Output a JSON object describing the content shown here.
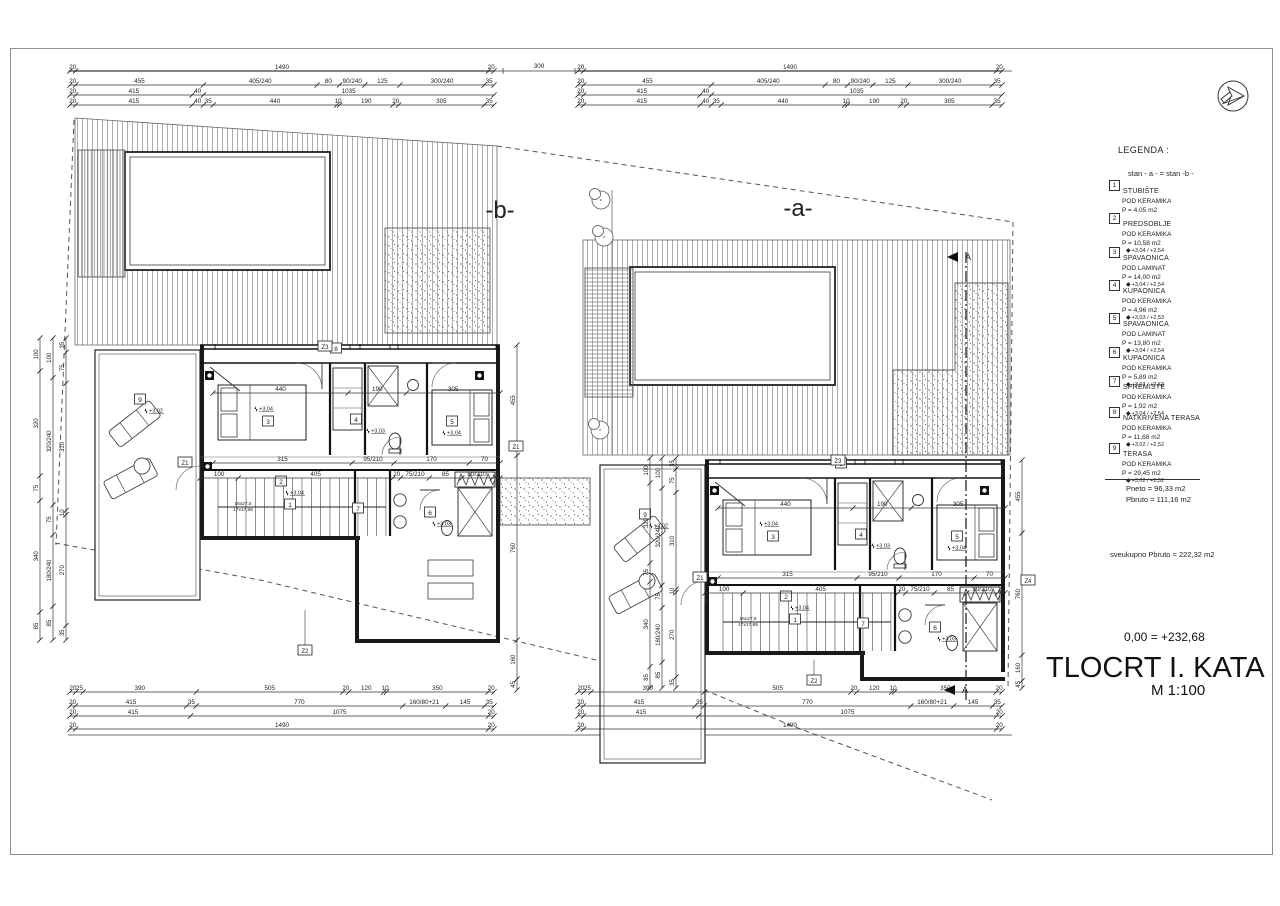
{
  "sheet": {
    "title": "TLOCRT I. KATA",
    "scale": "M 1:100",
    "datum": "0,00 = +232,68"
  },
  "units": {
    "b": "-b-",
    "a": "-a-"
  },
  "section": {
    "label": "A"
  },
  "markers": {
    "z1": "Z1",
    "z2": "Z2",
    "z3": "Z3",
    "z4": "Z4"
  },
  "stairs": {
    "line1": "16x27,5",
    "line2": "17x17,88"
  },
  "rooms": {
    "r1": {
      "num": "1"
    },
    "r2": {
      "num": "2",
      "level": "+3,04"
    },
    "r3": {
      "num": "3",
      "level": "+3,04"
    },
    "r4": {
      "num": "4",
      "level": "+3,03"
    },
    "r5": {
      "num": "5",
      "level": "+3,04"
    },
    "r6": {
      "num": "6",
      "level": "+3,03"
    },
    "r7": {
      "num": "7"
    },
    "r8": {
      "num": "8"
    },
    "r9": {
      "num": "9",
      "level": "+3,02"
    }
  },
  "dims": {
    "gap": "300",
    "top": [
      [
        "20",
        "1490",
        "20"
      ],
      [
        "20",
        "455",
        "405/240",
        "80",
        "90/240",
        "125",
        "300/240",
        "35"
      ],
      [
        "20",
        "415",
        "40",
        "1035"
      ],
      [
        "20",
        "415",
        "40",
        "35",
        "440",
        "10",
        "190",
        "20",
        "305",
        "35"
      ]
    ],
    "bottom": [
      [
        "20",
        "25",
        "390",
        "505",
        "20",
        "120",
        "10",
        "350",
        "20"
      ],
      [
        "20",
        "415",
        "35",
        "770",
        "160/80+21",
        "145",
        "35"
      ],
      [
        "20",
        "415",
        "1075",
        "20"
      ],
      [
        "20",
        "1490",
        "20"
      ]
    ],
    "left": [
      [
        "100",
        "320",
        "75",
        "340",
        "85"
      ],
      [
        "100",
        "320/240",
        "75",
        "180/240",
        "85"
      ],
      [
        "35",
        "75",
        "310",
        "10",
        "270",
        "35"
      ]
    ],
    "right": [
      "455",
      "760",
      "160",
      "45"
    ],
    "interior": {
      "r1": [
        "315",
        "95/210",
        "170",
        "70"
      ],
      "r2": [
        "100",
        "405",
        "20",
        "75/210",
        "85",
        "80/210",
        "20"
      ],
      "r3": [
        "440",
        "190",
        "305"
      ]
    }
  },
  "legend": {
    "heading": "LEGENDA :",
    "note": "stan - a - = stan -b -",
    "items": [
      {
        "num": "1",
        "name": "STUBIŠTE",
        "floor": "POD KERAMIKA",
        "area": "P = 4,05 m2",
        "levels": ""
      },
      {
        "num": "2",
        "name": "PREDSOBLJE",
        "floor": "POD KERAMIKA",
        "area": "P = 10,58 m2",
        "levels": "+3,04 / +2,54"
      },
      {
        "num": "3",
        "name": "SPAVAONICA",
        "floor": "POD LAMINAT",
        "area": "P = 14,00 m2",
        "levels": "+3,04 / +2,54"
      },
      {
        "num": "4",
        "name": "KUPAONICA",
        "floor": "POD KERAMIKA",
        "area": "P = 4,96 m2",
        "levels": "+3,03 / +2,53"
      },
      {
        "num": "5",
        "name": "SPAVAONICA",
        "floor": "POD LAMINAT",
        "area": "P = 13,80 m2",
        "levels": "+3,04 / +2,54"
      },
      {
        "num": "6",
        "name": "KUPAONICA",
        "floor": "POD KERAMIKA",
        "area": "P = 5,89 m2",
        "levels": "+3,03 / +2,53"
      },
      {
        "num": "7",
        "name": "SPREMIŠTE",
        "floor": "POD KERAMIKA",
        "area": "P = 1,92 m2",
        "levels": "+3,04 / +2,54"
      },
      {
        "num": "8",
        "name": "NATKRIVENA TERASA",
        "floor": "POD KERAMIKA",
        "area": "P = 11,68 m2",
        "levels": "+3,02 / +2,52"
      },
      {
        "num": "9",
        "name": "TERASA",
        "floor": "POD KERAMIKA",
        "area": "P = 29,45 m2",
        "levels": "+3,02 / +2,52"
      }
    ],
    "pneto": "Pneto = 96,33 m2",
    "pbruto": "Pbruto = 111,16 m2",
    "total": "sveukupno Pbruto = 222,32 m2"
  }
}
